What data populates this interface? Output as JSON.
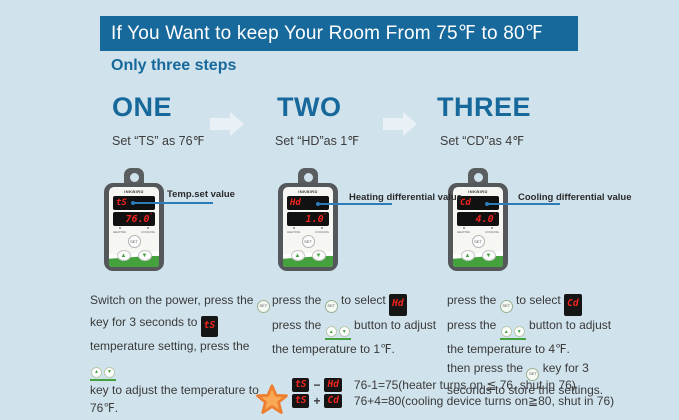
{
  "colors": {
    "bg": "#d0e2ec",
    "banner": "#17699c",
    "teal": "#17689b",
    "text": "#3a3a3a",
    "led": "#f5251d",
    "green": "#44a13e",
    "pointer": "#2d7cba",
    "starfill": "#f9a853",
    "starstroke": "#ee7d2e",
    "arrow": "#e9f1f6"
  },
  "header": {
    "title": "If You Want to keep Your Room From 75℉ to 80℉",
    "subtitle": "Only three steps"
  },
  "icons": {
    "set": "SET",
    "up": "▲",
    "down": "▼"
  },
  "steps": [
    {
      "number": "ONE",
      "caption": "Set “TS” as 76℉",
      "callout": "Temp.set value",
      "device": {
        "brand": "INKBIRD",
        "top_display": "tS",
        "bottom_display": "76.0",
        "degree": "°",
        "set_label": "SET",
        "heating_label": "HEATING",
        "cooling_label": "COOLING"
      },
      "lines": {
        "l1a": "Switch on the power, press the",
        "l2a": "key for 3 seconds to",
        "l2chip": "tS",
        "l3a": "temperature setting, press the",
        "l4": "key to adjust the temperature to",
        "l5": "76℉."
      }
    },
    {
      "number": "TWO",
      "caption": "Set “HD”as 1℉",
      "callout": "Heating differential value",
      "device": {
        "brand": "INKBIRD",
        "top_display": "Hd",
        "bottom_display": "1.0",
        "degree": "°",
        "set_label": "SET",
        "heating_label": "HEATING",
        "cooling_label": "COOLING"
      },
      "lines": {
        "l1a": "press the",
        "l1b": "to select",
        "l1chip": "Hd",
        "l2a": "press the",
        "l2b": "button to adjust",
        "l3": "the temperature to 1℉."
      }
    },
    {
      "number": "THREE",
      "caption": "Set “CD”as 4℉",
      "callout": "Cooling differential value",
      "device": {
        "brand": "INKBIRD",
        "top_display": "Cd",
        "bottom_display": "4.0",
        "degree": "°",
        "set_label": "SET",
        "heating_label": "HEATING",
        "cooling_label": "COOLING"
      },
      "lines": {
        "l1a": "press the",
        "l1b": "to select",
        "l1chip": "Cd",
        "l2a": "press the",
        "l2b": "button to adjust",
        "l3": "the temperature to 4℉.",
        "l4a": "then press the",
        "l4b": "key for 3",
        "l5": "seconds to store the settings."
      }
    }
  ],
  "footnote": {
    "lines": [
      {
        "chip1": "tS",
        "op": "−",
        "chip2": "Hd",
        "text": "76-1=75(heater turns on ≦ 76, shut in 76)"
      },
      {
        "chip1": "tS",
        "op": "+",
        "chip2": "Cd",
        "text": "76+4=80(cooling device turns on≧80, shut in 76)"
      }
    ]
  }
}
